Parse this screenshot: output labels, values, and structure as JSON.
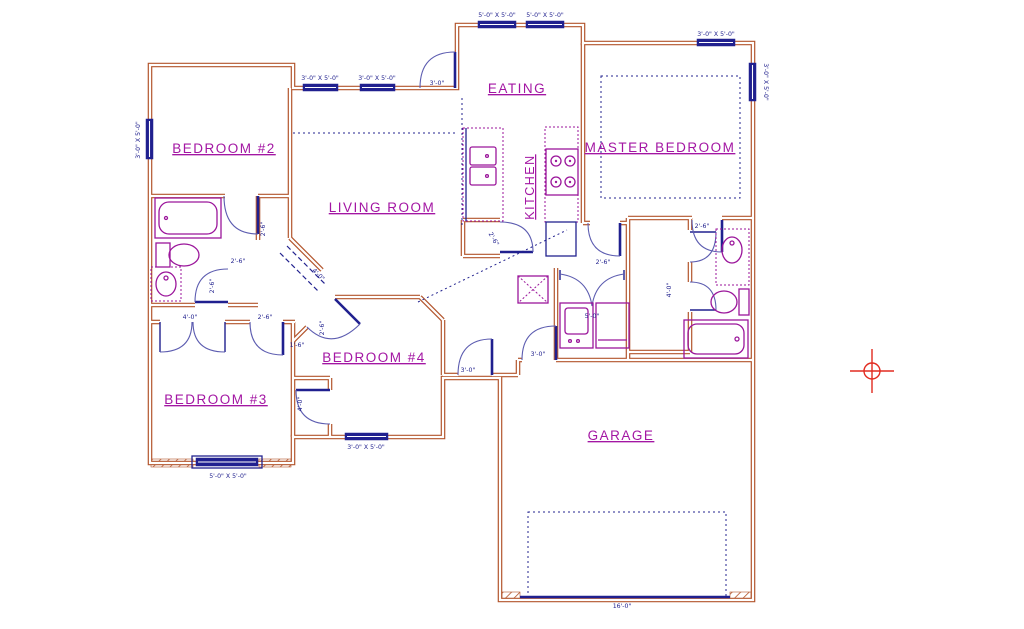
{
  "drawing": {
    "type": "residential-floor-plan",
    "colors": {
      "wall": "#b3552c",
      "lines": "#20208f",
      "fixtures": "#9b169b",
      "room_labels": "#a316a3",
      "target": "#e22b20",
      "background": "#ffffff"
    },
    "rooms": {
      "bedroom2": "BEDROOM #2",
      "living": "LIVING ROOM",
      "eating": "EATING",
      "kitchen": "KITCHEN",
      "master": "MASTER BEDROOM",
      "bedroom3": "BEDROOM #3",
      "bedroom4": "BEDROOM #4",
      "garage": "GARAGE"
    },
    "dims": {
      "win_3x5": "3'-0\" X 5'-0\"",
      "win_5x5": "5'-0\" X 5'-0\"",
      "d_3_0": "3'-0\"",
      "d_2_6": "2'-6\"",
      "d_1_6": "1'-6\"",
      "d_4_0": "4'-0\"",
      "d_5_0": "5'-0\"",
      "garage_opening": "16'-0\""
    }
  }
}
